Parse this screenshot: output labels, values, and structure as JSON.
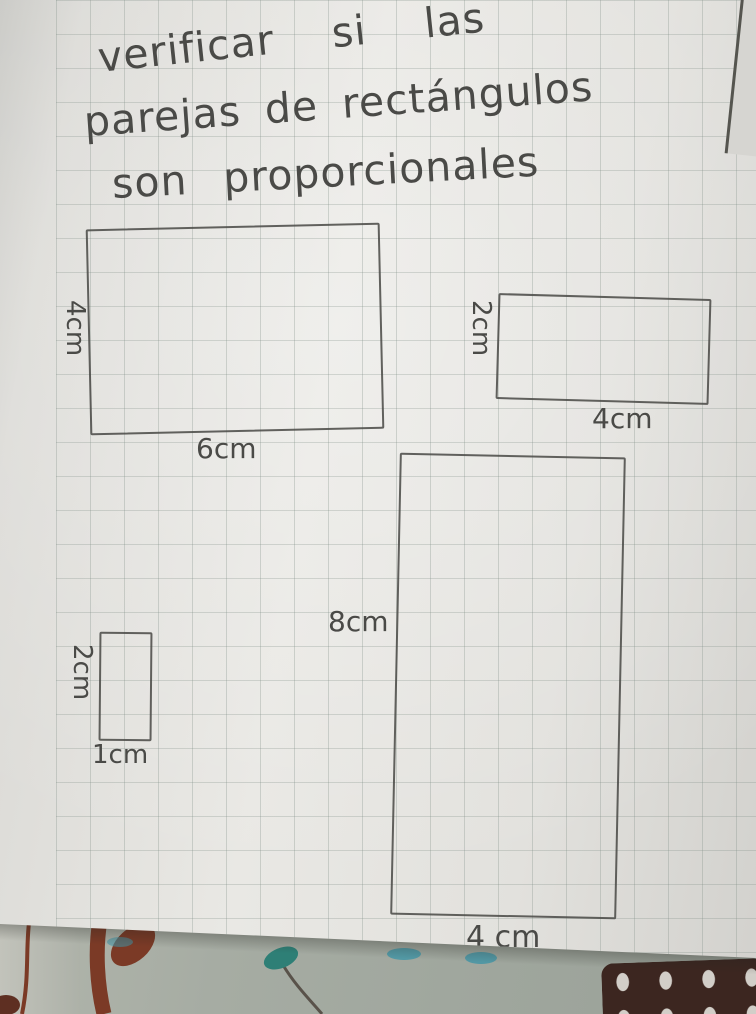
{
  "title": {
    "lines": [
      "verificar si las",
      "parejas de rectángulos",
      "son proporcionales"
    ]
  },
  "rectangles": [
    {
      "name": "rectangle-6x4",
      "width_label": "6cm",
      "height_label": "4cm"
    },
    {
      "name": "rectangle-4x2",
      "width_label": "4cm",
      "height_label": "2cm"
    },
    {
      "name": "rectangle-1x2",
      "width_label": "1cm",
      "height_label": "2cm"
    },
    {
      "name": "rectangle-4x8",
      "width_label": "4 cm",
      "height_label": "8cm"
    }
  ],
  "colors": {
    "paper": "#e7e6e2",
    "grid_line": "#aab4ac",
    "pencil": "#4a4a47",
    "fabric": "#a6aca3",
    "floral_maroon": "#7b3a26",
    "teal_bud": "#2e7f76",
    "teal_dab": "#3f93a5",
    "crochet_brown": "#3c2620"
  }
}
